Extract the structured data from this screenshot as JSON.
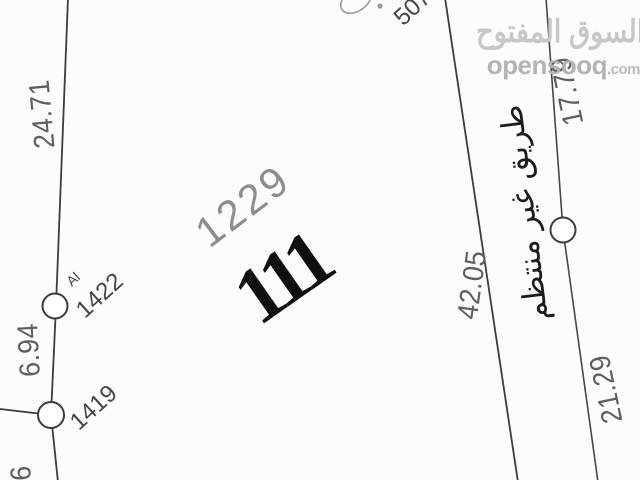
{
  "watermark": {
    "arabic": "السوق المفتوح",
    "latin": "opensooq",
    "suffix": ".com"
  },
  "parcel": {
    "block_number": "1229",
    "plot_number": "111"
  },
  "road_label_arabic": "طريق غير منتظم",
  "dimensions": {
    "left_upper": "24.71",
    "left_middle": "6.94",
    "left_bottom_partial": "6",
    "right_boundary": "42.05",
    "road_upper": "17.79",
    "road_lower": "21.29"
  },
  "survey_points": {
    "top_point": "507",
    "point_a_prefix": "Al",
    "point_a": "1422",
    "point_b": "1419"
  },
  "colors": {
    "boundary_line": "#3c3c3c",
    "road_line": "#464646",
    "circle_stroke": "#3c3c3c",
    "circle_fill": "#ffffff",
    "faint_mark": "#9c9c9c",
    "dimension_text": "#5e5e5e",
    "block_text": "#8d8d8d",
    "plot_text": "#0f0f0f",
    "watermark_arabic": "#c7c7c7",
    "watermark_latin": "#b3b3b3"
  }
}
